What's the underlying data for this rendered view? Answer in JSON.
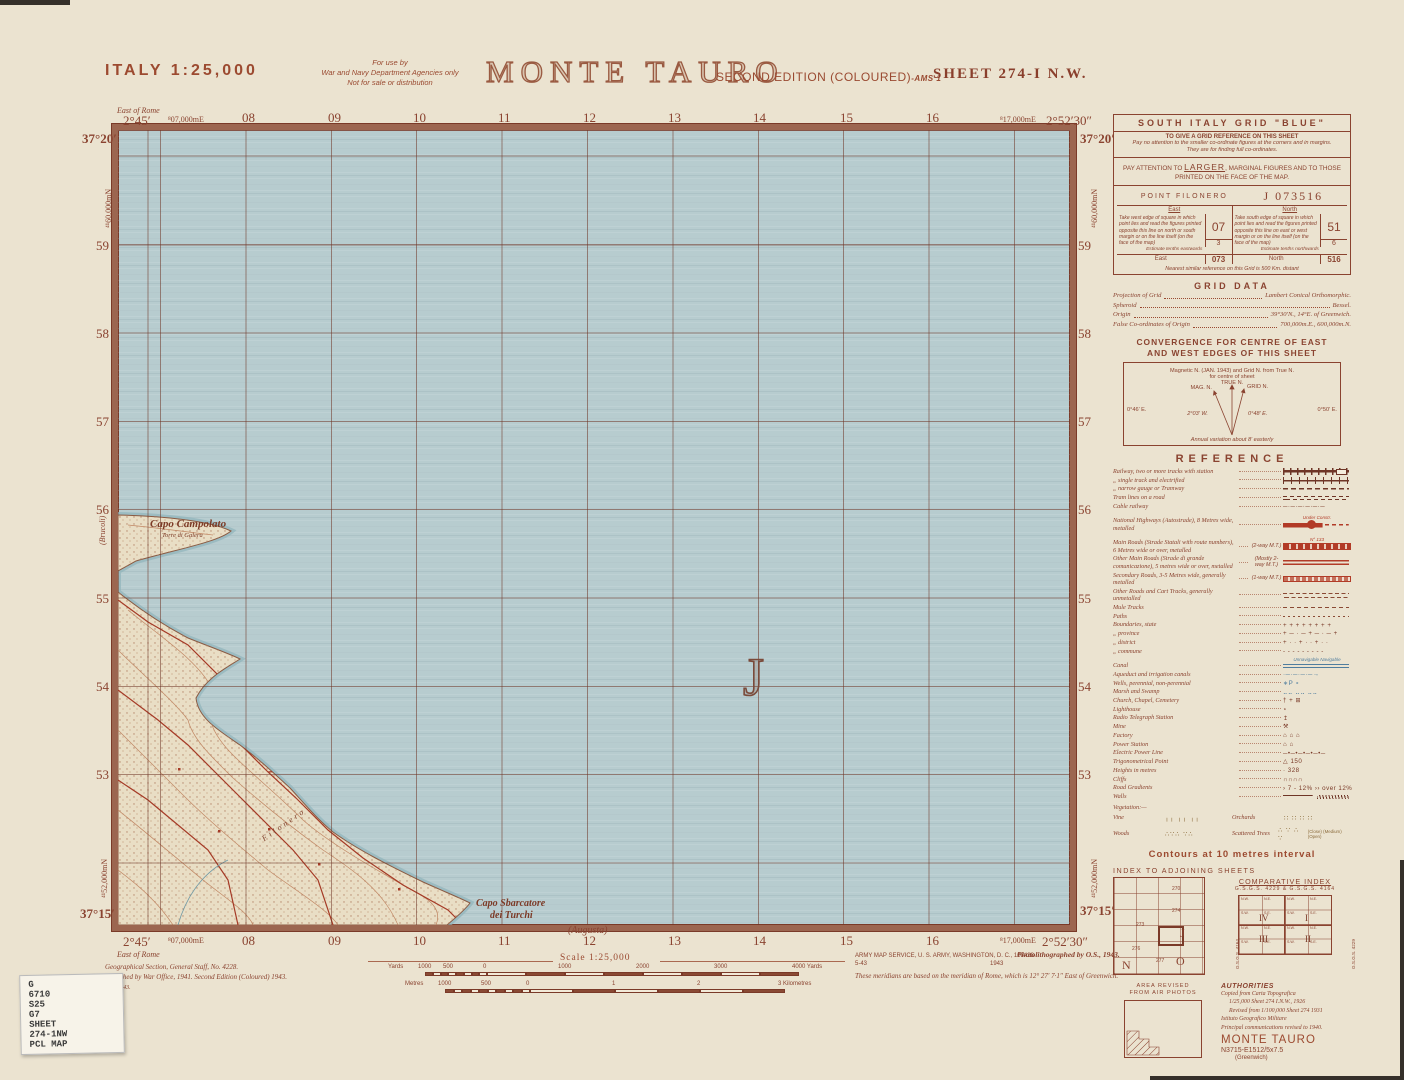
{
  "header": {
    "country_scale": "ITALY  1:25,000",
    "restriction": [
      "For use by",
      "War and Navy Department Agencies only",
      "Not for sale or distribution"
    ],
    "title": "MONTE TAURO",
    "edition": "SECOND EDITION (COLOURED)",
    "edition_suffix": "-AMS 1",
    "sheet": "SHEET  274-I  N.W."
  },
  "map": {
    "lat_top": "37°20′",
    "lat_bottom": "37°15′",
    "lon_left": "2°45′",
    "lon_right": "2°52′30″",
    "east_of_rome": "East of Rome",
    "eastings": [
      "⁸07,000mE",
      "08",
      "09",
      "10",
      "11",
      "12",
      "13",
      "14",
      "15",
      "16",
      "⁸17,000mE"
    ],
    "northings": [
      "59",
      "58",
      "57",
      "56",
      "55",
      "54",
      "53"
    ],
    "northing_full_top": "⁴¹60,000mN",
    "northing_full_bottom": "⁴¹52,000mN",
    "grid_letter": "J",
    "adjoining_west": "(Brucoli)",
    "adjoining_south": "(Augusta)",
    "labels": {
      "cape1": "Capo Campolato",
      "cape1_sub": "Torre di Galera",
      "cape2_line1": "Capo Sbarcatore",
      "cape2_line2": "dei Turchi",
      "area_name": "Filonero"
    }
  },
  "panel": {
    "grid_box": {
      "title": "SOUTH ITALY GRID \"BLUE\"",
      "line1": "TO GIVE A GRID REFERENCE ON THIS SHEET",
      "line2": "Pay no attention to the smaller co-ordinate figures at the corners and in margins.",
      "line3": "They are for finding full co-ordinates.",
      "attention_pre": "PAY ATTENTION TO ",
      "attention_em": "LARGER",
      "attention_post": ", MARGINAL FIGURES AND TO THOSE PRINTED ON THE FACE OF THE MAP.",
      "point_label": "POINT  FILONERO",
      "point_value": "J  073516",
      "east": {
        "head": "East",
        "body": "Take west edge of square in which point lies and read the figures printed opposite this line on north or south margin or on the line itself (on the face of the map)",
        "square": "07",
        "tenths_label": "Estimate tenths eastwards",
        "tenths": "3",
        "total_label": "East",
        "total": "073"
      },
      "north": {
        "head": "North",
        "body": "Take south edge of square in which point lies and read the figures printed opposite this line on east or west margin or on the line itself (on the face of the map)",
        "square": "51",
        "tenths_label": "Estimate tenths northwards",
        "tenths": "6",
        "total_label": "North",
        "total": "516"
      },
      "footnote": "Nearest similar reference on this Grid is 500 Km. distant"
    },
    "grid_data": {
      "title": "GRID DATA",
      "rows": [
        [
          "Projection of Grid",
          "Lambert Conical Orthomorphic."
        ],
        [
          "Spheroid",
          "Bessel."
        ],
        [
          "Origin",
          "39°30′N., 14°E. of Greenwich."
        ],
        [
          "False Co-ordinates of Origin",
          "700,000m.E., 600,000m.N."
        ]
      ]
    },
    "convergence": {
      "title1": "CONVERGENCE FOR CENTRE OF EAST",
      "title2": "AND WEST EDGES OF THIS SHEET",
      "note1": "Magnetic N. (JAN. 1943) and Grid N. from True N.",
      "note2": "for centre of sheet",
      "true_n": "TRUE N.",
      "mag_n": "MAG. N.",
      "grid_n": "GRID N.",
      "left_val": "0°46′ E.",
      "right_val": "0°50′ E.",
      "mag_val": "2°03′ W.",
      "grid_val": "0°48′ E.",
      "annual": "Annual variation about 8′ easterly"
    },
    "reference": {
      "title": "REFERENCE",
      "items": [
        {
          "label": "Railway, two or more tracks with station",
          "sym": "rail2"
        },
        {
          "label": "„     single track and electrified",
          "sym": "rail1"
        },
        {
          "label": "„     narrow gauge or Tramway",
          "sym": "railn"
        },
        {
          "label": "Tram lines on a road",
          "sym": "tram"
        },
        {
          "label": "Cable railway",
          "sym": "text",
          "symtext": "─·─·─·─·─·─"
        },
        {
          "label": "National Highways (Autostrade), 8 Metres wide, metalled",
          "sym": "auto",
          "symcap": "Under Constr."
        },
        {
          "label": "Main Roads (Strade Statali with route numbers), 6 Metres wide or over, metalled",
          "note": "(2-way M.T.)",
          "sym": "roadmain",
          "symcap": "N° 133"
        },
        {
          "label": "Other Main Roads (Strade di grande comunicazione), 5 metres wide or over, metalled",
          "note": "(Mostly 2-way M.T.)",
          "sym": "road2"
        },
        {
          "label": "Secondary Roads, 3-5 Metres wide, generally metalled",
          "note": "(1-way M.T.)",
          "sym": "roadsec"
        },
        {
          "label": "Other Roads and Cart Tracks, generally unmetalled",
          "sym": "unmet"
        },
        {
          "label": "Mule Tracks",
          "sym": "mule"
        },
        {
          "label": "Paths",
          "sym": "path"
        },
        {
          "label": "Boundaries, state",
          "sym": "text",
          "symtext": "+ + + + + + + +"
        },
        {
          "label": "„     province",
          "sym": "text",
          "symtext": "+ ─ · ─ + ─ · ─ +"
        },
        {
          "label": "„     district",
          "sym": "text",
          "symtext": "+ · · + · · + · ·"
        },
        {
          "label": "„     commune",
          "sym": "text",
          "symtext": "- - - - - - - - -"
        },
        {
          "label": "Canal",
          "sym": "canal",
          "symcap": "Unnavigable   Navigable"
        },
        {
          "label": "Aqueduct and irrigation canals",
          "sym": "textblue",
          "symtext": "·─·─·─·─→"
        },
        {
          "label": "Wells, perennial, non-perennial",
          "sym": "textblue",
          "symtext": "∗P       ∘"
        },
        {
          "label": "Marsh and Swamp",
          "sym": "textblue",
          "symtext": "⣀⣀  ⣀⣀  ⣀⣀"
        },
        {
          "label": "Church, Chapel, Cemetery",
          "sym": "text",
          "symtext": "†    +    ⊞"
        },
        {
          "label": "Lighthouse",
          "sym": "text",
          "symtext": "⋆"
        },
        {
          "label": "Radio Telegraph Station",
          "sym": "text",
          "symtext": "↥"
        },
        {
          "label": "Mine",
          "sym": "text",
          "symtext": "⚒"
        },
        {
          "label": "Factory",
          "sym": "text",
          "symtext": "⌂  ⌂  ⌂"
        },
        {
          "label": "Power Station",
          "sym": "text",
          "symtext": "⌂  ⌂"
        },
        {
          "label": "Electric Power Line",
          "sym": "text",
          "symtext": "─•─•─•─•─•─"
        },
        {
          "label": "Trigonometrical Point",
          "sym": "text",
          "symtext": "△ 150"
        },
        {
          "label": "Heights in metres",
          "sym": "text",
          "symtext": "· 328"
        },
        {
          "label": "Cliffs",
          "sym": "text",
          "symtext": "∩∩∩∩"
        },
        {
          "label": "Road Gradients",
          "sym": "text",
          "symtext": "› 7 - 12%   ›› over 12%"
        },
        {
          "label": "Walls",
          "sym": "wall"
        }
      ],
      "vegetation_label": "Vegetation:—",
      "veg": [
        {
          "label": "Vine",
          "symtext": "╷╷ ╷╷ ╷╷"
        },
        {
          "label": "Orchards",
          "symtext": "∷ ∷ ∷ ∷"
        },
        {
          "label": "Woods",
          "symtext": "∴∵∴ ∵∴"
        },
        {
          "label": "Scattered Trees",
          "symtext": "∴ ∵ ∴ ∵",
          "caption": "(Close) (Medium) (Open)"
        }
      ],
      "contours": "Contours at 10 metres interval"
    },
    "index_adjoining": {
      "title": "INDEX TO ADJOINING SHEETS",
      "labels": [
        "270",
        "273",
        "274",
        "J",
        "N",
        "O",
        "276",
        "277"
      ]
    },
    "comparative": {
      "title": "COMPARATIVE INDEX",
      "subtitle": "G.S.G.S. 4229  &  G.S.G.S. 4164",
      "left_label": "G.S.G.S. 4164",
      "right_label": "G.S.G.S. 4229",
      "quads": [
        "IV",
        "I",
        "III",
        "II"
      ],
      "cells": [
        "N.W.",
        "N.E.",
        "S.W.",
        "S.E."
      ]
    },
    "area_revised": {
      "line1": "AREA REVISED",
      "line2": "FROM AIR PHOTOS"
    },
    "authorities": {
      "title": "AUTHORITIES",
      "lines": [
        "Copied from Carta Topografica",
        "1/25,000 Sheet 274 I.N.W., 1926",
        "Revised from 1/100,000 Sheet 274  1931",
        "Istituto Geografico Militare",
        "Principal communications revised to 1940."
      ],
      "name": "MONTE TAURO",
      "ref": "N3715-E1512/5x7.5",
      "greenwich": "(Greenwich)"
    }
  },
  "footer": {
    "scale_label": "Scale 1:25,000",
    "yards_unit": "Yards",
    "yards_labels": [
      "1000",
      "500",
      "0",
      "1000",
      "2000",
      "3000",
      "4000 Yards"
    ],
    "metres_unit": "Metres",
    "metres_labels": [
      "1000",
      "500",
      "0",
      "1",
      "2",
      "3 Kilometres"
    ],
    "gsgs": [
      "Geographical Section, General Staff, No. 4228.",
      "Published by War Office, 1941. Second Edition (Coloured) 1943."
    ],
    "wo": "W.O./3/43.",
    "ams1": "ARMY MAP SERVICE, U. S. ARMY, WASHINGTON, D. C., 108428",
    "ams2a": "5-43",
    "ams2b": "1943",
    "photo": "Photolithographed by O.S., 1943.",
    "meridian": "These meridians are based on the meridian of Rome, which is 12° 27′ 7·1″ East of Greenwich."
  },
  "sticker": {
    "lines": [
      "G",
      "6710",
      "S25",
      "G7",
      "SHEET",
      "274-1NW",
      "PCL MAP"
    ]
  }
}
